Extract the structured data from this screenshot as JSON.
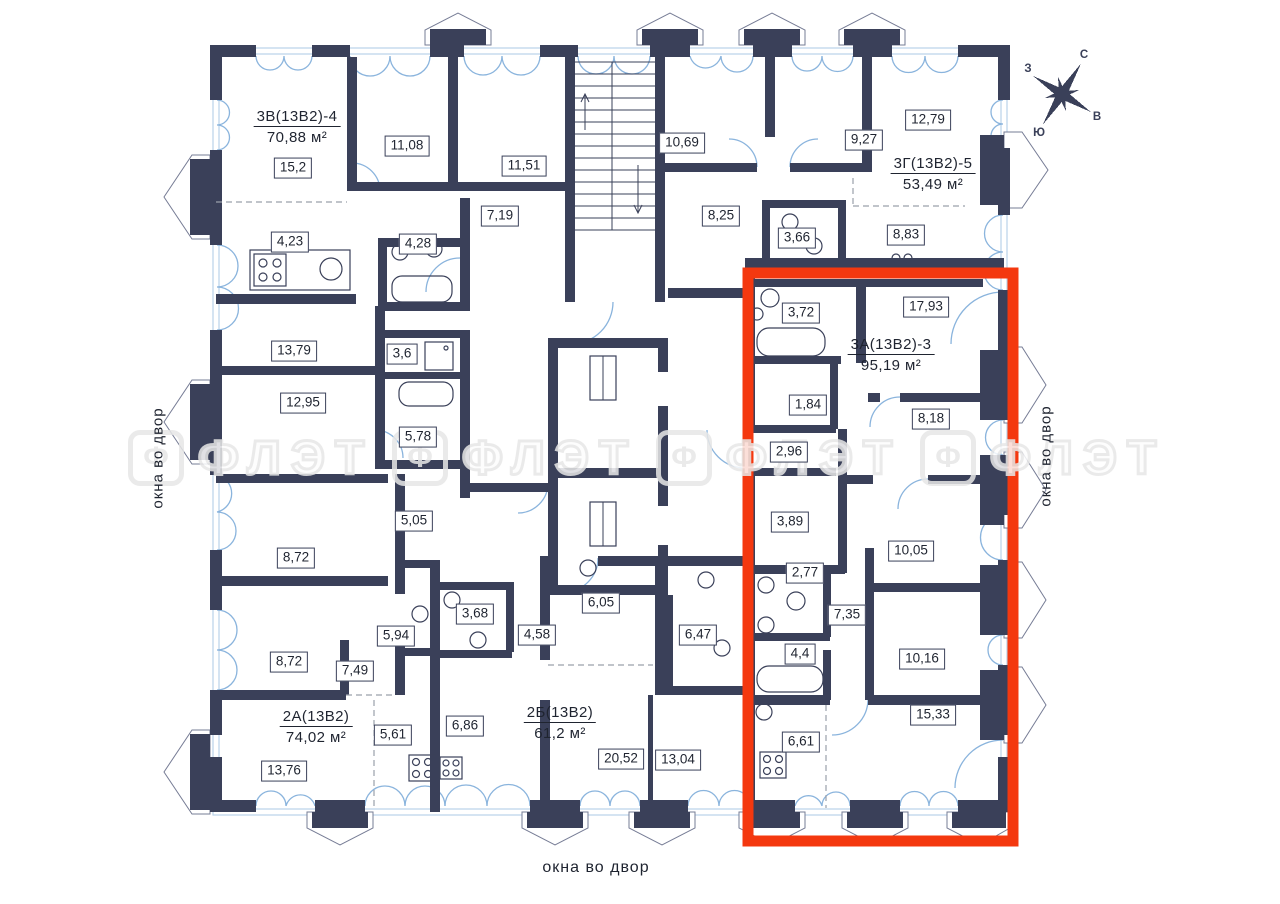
{
  "plan_title": "floor-plan",
  "colors": {
    "wall": "#3a4059",
    "window": "#8ab4dd",
    "sill": "#b9d3ea",
    "accent": "#f4380f",
    "dash": "#9aa0ab",
    "label_ink": "#1f2430",
    "watermark": "#e7e7e7"
  },
  "apartments": [
    {
      "name": "3В(13В2)-4",
      "area": "70,88",
      "unit": "м²",
      "x": 297,
      "y": 108
    },
    {
      "name": "3Г(13В2)-5",
      "area": "53,49",
      "unit": "м²",
      "x": 933,
      "y": 155
    },
    {
      "name": "3А(13В2)-3",
      "area": "95,19",
      "unit": "м²",
      "x": 891,
      "y": 336,
      "highlighted": true
    },
    {
      "name": "2А(13В2)",
      "area": "74,02",
      "unit": "м²",
      "x": 316,
      "y": 708
    },
    {
      "name": "2Б(13В2)",
      "area": "61,2",
      "unit": "м²",
      "x": 560,
      "y": 704
    }
  ],
  "room_labels": [
    {
      "value": "15,2",
      "x": 293,
      "y": 168
    },
    {
      "value": "11,08",
      "x": 407,
      "y": 146
    },
    {
      "value": "11,51",
      "x": 524,
      "y": 166
    },
    {
      "value": "7,19",
      "x": 500,
      "y": 216
    },
    {
      "value": "4,23",
      "x": 290,
      "y": 242
    },
    {
      "value": "4,28",
      "x": 418,
      "y": 244
    },
    {
      "value": "10,69",
      "x": 682,
      "y": 143
    },
    {
      "value": "9,27",
      "x": 864,
      "y": 140
    },
    {
      "value": "12,79",
      "x": 928,
      "y": 120
    },
    {
      "value": "8,25",
      "x": 721,
      "y": 216
    },
    {
      "value": "3,66",
      "x": 797,
      "y": 238
    },
    {
      "value": "8,83",
      "x": 906,
      "y": 235
    },
    {
      "value": "13,79",
      "x": 294,
      "y": 351
    },
    {
      "value": "3,6",
      "x": 402,
      "y": 354
    },
    {
      "value": "12,95",
      "x": 303,
      "y": 403
    },
    {
      "value": "5,78",
      "x": 418,
      "y": 437
    },
    {
      "value": "5,05",
      "x": 414,
      "y": 521
    },
    {
      "value": "8,72",
      "x": 296,
      "y": 558
    },
    {
      "value": "8,72",
      "x": 289,
      "y": 662
    },
    {
      "value": "7,49",
      "x": 355,
      "y": 671
    },
    {
      "value": "5,94",
      "x": 396,
      "y": 636
    },
    {
      "value": "3,68",
      "x": 475,
      "y": 614
    },
    {
      "value": "5,61",
      "x": 393,
      "y": 735
    },
    {
      "value": "6,86",
      "x": 465,
      "y": 726
    },
    {
      "value": "13,76",
      "x": 284,
      "y": 771
    },
    {
      "value": "4,58",
      "x": 537,
      "y": 635
    },
    {
      "value": "6,05",
      "x": 601,
      "y": 603
    },
    {
      "value": "6,47",
      "x": 698,
      "y": 635
    },
    {
      "value": "20,52",
      "x": 621,
      "y": 759
    },
    {
      "value": "13,04",
      "x": 678,
      "y": 760
    },
    {
      "value": "3,72",
      "x": 801,
      "y": 313
    },
    {
      "value": "17,93",
      "x": 926,
      "y": 307
    },
    {
      "value": "1,84",
      "x": 808,
      "y": 405
    },
    {
      "value": "8,18",
      "x": 931,
      "y": 419
    },
    {
      "value": "2,96",
      "x": 789,
      "y": 452
    },
    {
      "value": "3,89",
      "x": 790,
      "y": 522
    },
    {
      "value": "10,05",
      "x": 911,
      "y": 551
    },
    {
      "value": "2,77",
      "x": 805,
      "y": 573
    },
    {
      "value": "7,35",
      "x": 847,
      "y": 615
    },
    {
      "value": "4,4",
      "x": 800,
      "y": 654
    },
    {
      "value": "10,16",
      "x": 922,
      "y": 659
    },
    {
      "value": "15,33",
      "x": 933,
      "y": 715
    },
    {
      "value": "6,61",
      "x": 801,
      "y": 742
    }
  ],
  "side_labels": {
    "left": "окна во двор",
    "right": "окна во двор",
    "bottom": "окна во двор"
  },
  "compass": {
    "north": "С",
    "east": "В",
    "south": "Ю",
    "west": "З"
  },
  "watermark": {
    "icon_letter": "Ф",
    "text": "ФЛЭТ",
    "positions": [
      {
        "x": 128,
        "y": 430
      },
      {
        "x": 392,
        "y": 430
      },
      {
        "x": 656,
        "y": 430
      },
      {
        "x": 920,
        "y": 430
      }
    ]
  }
}
